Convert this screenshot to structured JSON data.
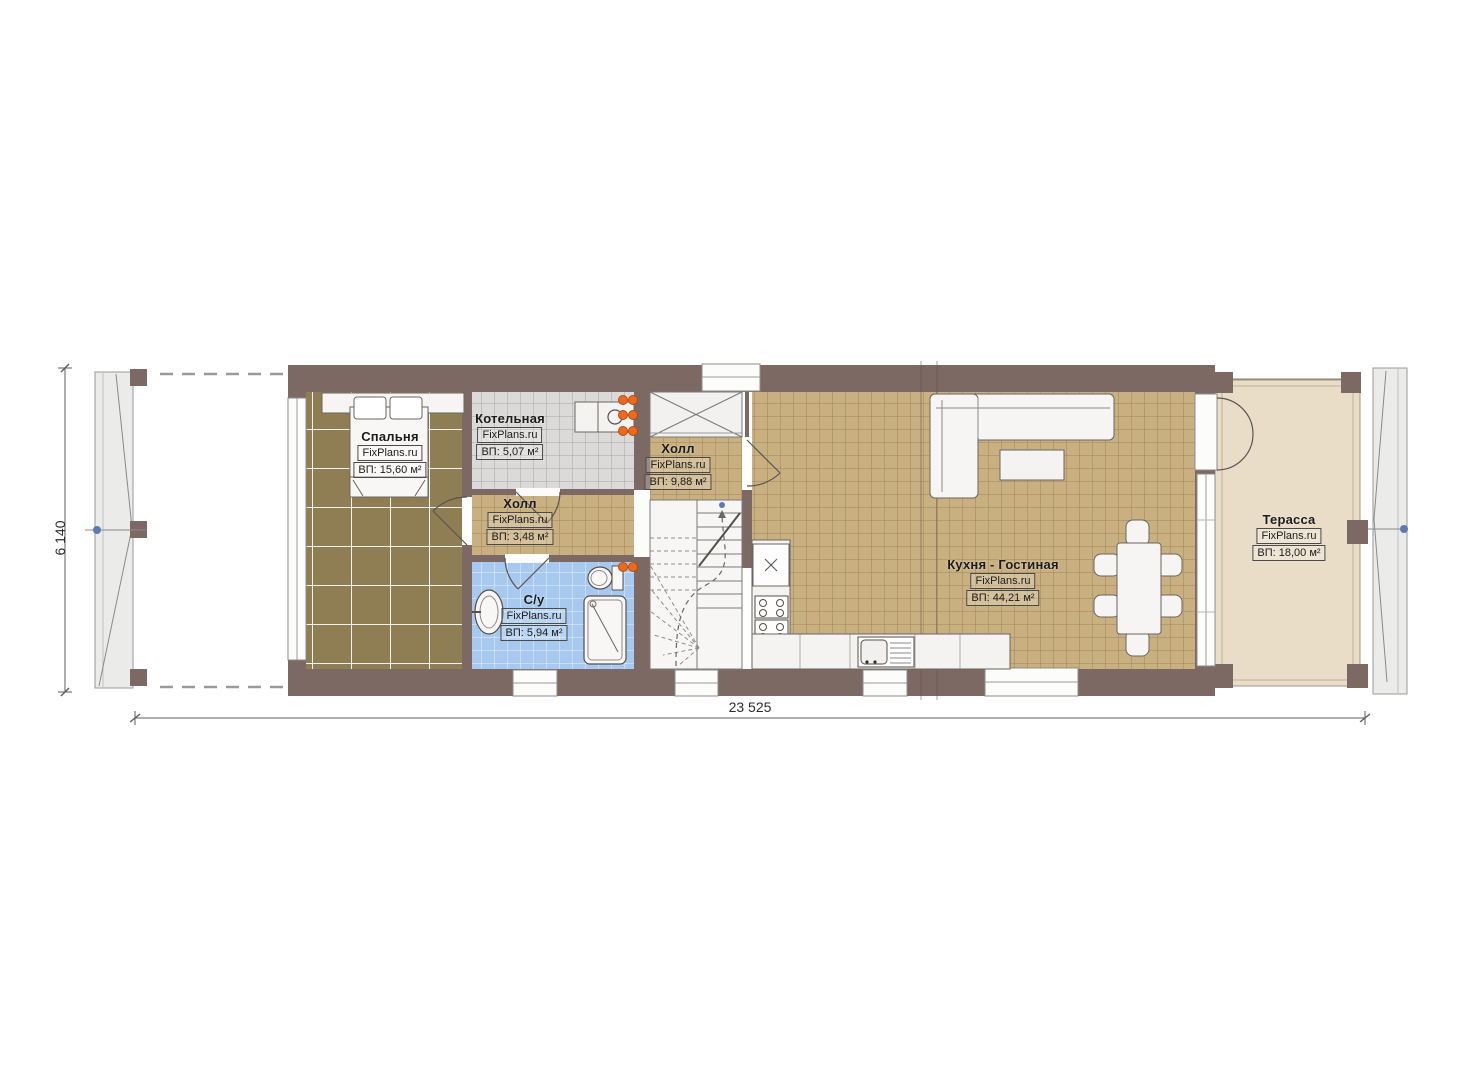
{
  "plan": {
    "watermark": "FixPlans.ru",
    "rooms": [
      {
        "name": "Спальня",
        "brand": "FixPlans.ru",
        "area": "ВП: 15,60 м²"
      },
      {
        "name": "Котельная",
        "brand": "FixPlans.ru",
        "area": "ВП: 5,07 м²"
      },
      {
        "name": "Холл",
        "brand": "FixPlans.ru",
        "area": "ВП: 3,48 м²"
      },
      {
        "name": "Холл",
        "brand": "FixPlans.ru",
        "area": "ВП: 9,88 м²"
      },
      {
        "name": "С/у",
        "brand": "FixPlans.ru",
        "area": "ВП: 5,94 м²"
      },
      {
        "name": "Кухня - Гостиная",
        "brand": "FixPlans.ru",
        "area": "ВП: 44,21 м²"
      },
      {
        "name": "Терасса",
        "brand": "FixPlans.ru",
        "area": "ВП: 18,00 м²"
      }
    ],
    "dimensions": {
      "overall_width": "23 525",
      "overall_height": "6 140"
    },
    "colors": {
      "wall": "#7c6964",
      "floor_bedroom": "#8f7d53",
      "floor_tile_tan": "#c9b080",
      "floor_tile_gray": "#dbdad8",
      "floor_tile_blue": "#a7c9ef",
      "floor_terrace": "#e9ddc8",
      "radiator_orange": "#ed6a1d",
      "marker_blue": "#5b79b3"
    }
  }
}
